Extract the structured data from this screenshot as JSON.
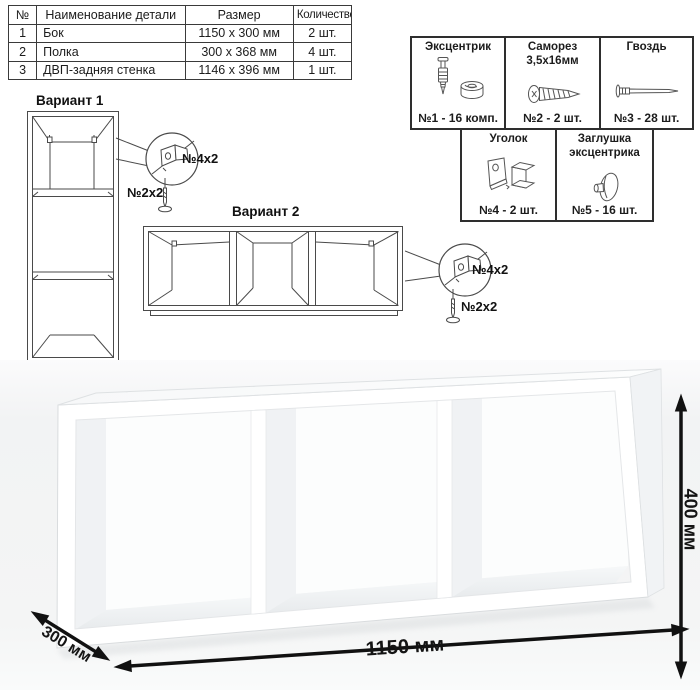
{
  "parts_table": {
    "headers": [
      "№",
      "Наименование детали",
      "Размер",
      "Количество"
    ],
    "rows": [
      [
        "1",
        "Бок",
        "1150 x 300 мм",
        "2 шт."
      ],
      [
        "2",
        "Полка",
        "300 x 368 мм",
        "4 шт."
      ],
      [
        "3",
        "ДВП-задняя стенка",
        "1146 x 396 мм",
        "1 шт."
      ]
    ]
  },
  "hardware": {
    "items": [
      {
        "title": "Эксцентрик",
        "count": "№1 - 16 комп.",
        "icon": "eccentric-cam-icon"
      },
      {
        "title": "Саморез 3,5х16мм",
        "count": "№2 - 2 шт.",
        "icon": "screw-icon"
      },
      {
        "title": "Гвоздь",
        "count": "№3 - 28 шт.",
        "icon": "nail-icon"
      },
      {
        "title": "Уголок",
        "count": "№4 - 2 шт.",
        "icon": "corner-bracket-icon"
      },
      {
        "title": "Заглушка эксцентрика",
        "count": "№5 - 16 шт.",
        "icon": "cam-cap-icon"
      }
    ]
  },
  "variants": {
    "variant1": {
      "label": "Вариант 1",
      "callout_bracket": "№4х2",
      "callout_screw": "№2х2"
    },
    "variant2": {
      "label": "Вариант 2",
      "callout_bracket": "№4х2",
      "callout_screw": "№2х2"
    }
  },
  "dimensions": {
    "width": "1150 мм",
    "depth": "300 мм",
    "height": "400 мм"
  },
  "colors": {
    "line_art": "#4a4a4a",
    "dimension_arrows": "#111111",
    "render_background": "#f3f4f5"
  }
}
